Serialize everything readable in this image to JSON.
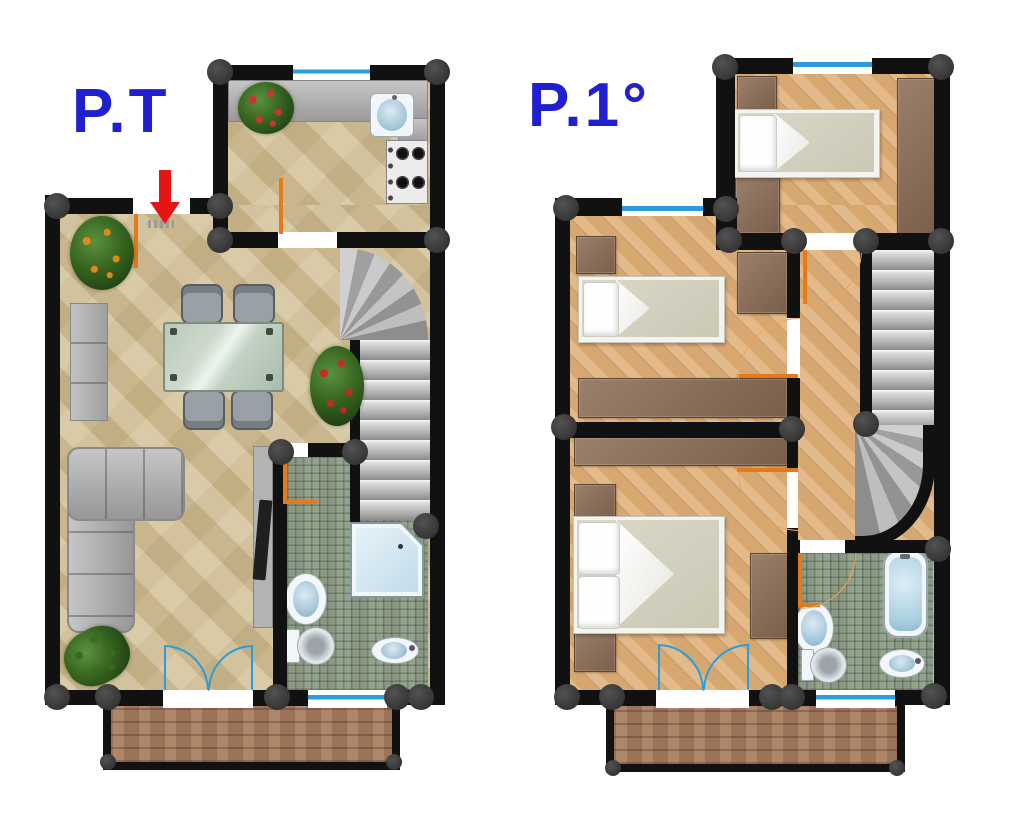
{
  "page": {
    "background": "#ffffff"
  },
  "floor_plans": [
    {
      "id": "ground",
      "label": "P.T"
    },
    {
      "id": "first",
      "label": "P.1°"
    }
  ],
  "icons": {
    "entrance_arrow": "red-down-arrow"
  },
  "colors": {
    "wall": "#111111",
    "column": "#3e3e3e",
    "label_blue": "#2020d0",
    "arrow_red": "#e81313",
    "window_blue": "#2b9dda",
    "door_orange": "#e8791a",
    "door_orange_light": "#f2a25e",
    "stone_floor": "#d3c096",
    "wood_floor": "#e0b27c",
    "tile_floor": "#93a28c",
    "brick_floor": "#a87d5f",
    "stair_gray": "#b5b5b5",
    "furniture_brown": "#8b7361",
    "furniture_gray": "#a9a9a9",
    "fixture_blue": "#c9e0ec"
  }
}
